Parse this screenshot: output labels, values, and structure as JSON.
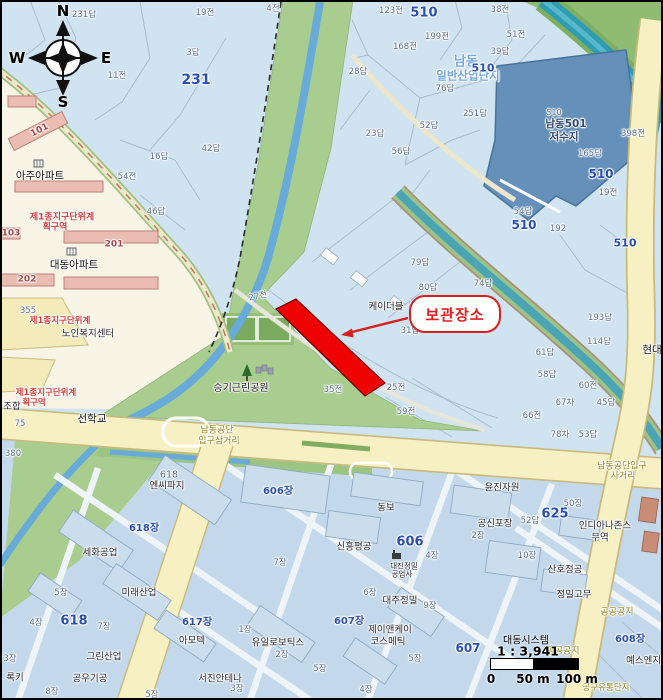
{
  "map": {
    "storage_label": "보관장소",
    "compass": {
      "n": "N",
      "w": "W",
      "e": "E",
      "s": "S"
    },
    "scale": {
      "company": "대동시스템",
      "ratio": "1 : 3,941",
      "tick_0": "0",
      "tick_50": "50 m",
      "tick_100": "100 m"
    },
    "colors": {
      "highlight_red": "#ee0202",
      "label_red": "#d62020",
      "base_blue": "#cfe3f1",
      "industrial_blue": "#c3d9eb",
      "road_yellow": "#f7f0c2",
      "park_green": "#a9cd8e",
      "stream_blue": "#68aad8",
      "river_teal": "#2f9cb4",
      "reservoir_blue": "#6490ba",
      "cream": "#f8f4e6"
    },
    "labels": [
      {
        "text": "231답",
        "x": 84,
        "y": 15,
        "c": "g"
      },
      {
        "text": "19전",
        "x": 205,
        "y": 13,
        "c": "g"
      },
      {
        "text": "4전",
        "x": 273,
        "y": 9,
        "c": "g"
      },
      {
        "text": "123전",
        "x": 391,
        "y": 11,
        "c": "g"
      },
      {
        "text": "510",
        "x": 424,
        "y": 13,
        "c": "bb"
      },
      {
        "text": "38전",
        "x": 500,
        "y": 10,
        "c": "g"
      },
      {
        "text": "3답",
        "x": 193,
        "y": 53,
        "c": "g"
      },
      {
        "text": "231",
        "x": 196,
        "y": 80,
        "c": "bb",
        "s": 14
      },
      {
        "text": "11전",
        "x": 117,
        "y": 76,
        "c": "g"
      },
      {
        "text": "199전",
        "x": 437,
        "y": 37,
        "c": "g"
      },
      {
        "text": "51전",
        "x": 516,
        "y": 35,
        "c": "g"
      },
      {
        "text": "168전",
        "x": 405,
        "y": 47,
        "c": "g"
      },
      {
        "text": "39답",
        "x": 500,
        "y": 52,
        "c": "g"
      },
      {
        "text": "28답",
        "x": 358,
        "y": 72,
        "c": "g"
      },
      {
        "text": "남동",
        "x": 466,
        "y": 62,
        "c": "lb"
      },
      {
        "text": "일반산업단지",
        "x": 468,
        "y": 76,
        "c": "lb",
        "s": 11.5
      },
      {
        "text": "510",
        "x": 483,
        "y": 68,
        "c": "bb",
        "s": 11
      },
      {
        "text": "76답",
        "x": 445,
        "y": 89,
        "c": "g"
      },
      {
        "text": "251답",
        "x": 475,
        "y": 114,
        "c": "g"
      },
      {
        "text": "52답",
        "x": 429,
        "y": 126,
        "c": "g"
      },
      {
        "text": "23답",
        "x": 375,
        "y": 134,
        "c": "g"
      },
      {
        "text": "56답",
        "x": 401,
        "y": 152,
        "c": "g"
      },
      {
        "text": "42답",
        "x": 211,
        "y": 149,
        "c": "g"
      },
      {
        "text": "16답",
        "x": 159,
        "y": 157,
        "c": "g"
      },
      {
        "text": "54전",
        "x": 127,
        "y": 177,
        "c": "g"
      },
      {
        "text": "46답",
        "x": 156,
        "y": 212,
        "c": "g"
      },
      {
        "text": "510",
        "x": 554,
        "y": 113,
        "c": "g",
        "s": 8
      },
      {
        "text": "남동501",
        "x": 566,
        "y": 124,
        "c": "nv"
      },
      {
        "text": "저수지",
        "x": 564,
        "y": 137,
        "c": "nv"
      },
      {
        "text": "398전",
        "x": 633,
        "y": 134,
        "c": "g"
      },
      {
        "text": "165답",
        "x": 590,
        "y": 154,
        "c": "g"
      },
      {
        "text": "510",
        "x": 601,
        "y": 174,
        "c": "bb",
        "s": 12
      },
      {
        "text": "19전",
        "x": 608,
        "y": 193,
        "c": "g"
      },
      {
        "text": "54답",
        "x": 523,
        "y": 212,
        "c": "g"
      },
      {
        "text": "510",
        "x": 524,
        "y": 225,
        "c": "bb",
        "s": 12
      },
      {
        "text": "192",
        "x": 558,
        "y": 229,
        "c": "g"
      },
      {
        "text": "510",
        "x": 625,
        "y": 243,
        "c": "bb",
        "s": 11
      },
      {
        "text": "101",
        "x": 40,
        "y": 131,
        "c": "dr",
        "rot": -27
      },
      {
        "text": "아주아파트",
        "x": 40,
        "y": 176,
        "c": "kb"
      },
      {
        "text": "제1종지구단위계",
        "x": 62,
        "y": 218,
        "c": "r"
      },
      {
        "text": "획구역",
        "x": 55,
        "y": 228,
        "c": "r"
      },
      {
        "text": "103",
        "x": 11,
        "y": 234,
        "c": "dr"
      },
      {
        "text": "201",
        "x": 114,
        "y": 245,
        "c": "dr"
      },
      {
        "text": "대동아파트",
        "x": 74,
        "y": 265,
        "c": "kb"
      },
      {
        "text": "202",
        "x": 27,
        "y": 280,
        "c": "dr"
      },
      {
        "text": "355",
        "x": 28,
        "y": 311,
        "c": "g"
      },
      {
        "text": "제1종지구단위계",
        "x": 60,
        "y": 321,
        "c": "r",
        "s": 8.5
      },
      {
        "text": "노인복지센터",
        "x": 88,
        "y": 334,
        "c": "k"
      },
      {
        "text": "제1종지구단위계",
        "x": 46,
        "y": 393,
        "c": "r",
        "s": 8.5
      },
      {
        "text": "획구역",
        "x": 34,
        "y": 403,
        "c": "r",
        "s": 8.5
      },
      {
        "text": "조합",
        "x": 12,
        "y": 407,
        "c": "k"
      },
      {
        "text": "75",
        "x": 20,
        "y": 424,
        "c": "g"
      },
      {
        "text": "380",
        "x": 13,
        "y": 454,
        "c": "g"
      },
      {
        "text": "선학교",
        "x": 92,
        "y": 419,
        "c": "kb"
      },
      {
        "text": "남동공단",
        "x": 217,
        "y": 431,
        "c": "o"
      },
      {
        "text": "입구삼거리",
        "x": 219,
        "y": 442,
        "c": "o"
      },
      {
        "text": "승기근린공원",
        "x": 241,
        "y": 389,
        "c": "kb",
        "s": 10
      },
      {
        "text": "27전",
        "x": 258,
        "y": 297,
        "c": "g",
        "rot": -12
      },
      {
        "text": "케이더블",
        "x": 386,
        "y": 307,
        "c": "k"
      },
      {
        "text": "79답",
        "x": 420,
        "y": 263,
        "c": "g"
      },
      {
        "text": "80답",
        "x": 428,
        "y": 288,
        "c": "g"
      },
      {
        "text": "74답",
        "x": 483,
        "y": 284,
        "c": "g"
      },
      {
        "text": "31답",
        "x": 410,
        "y": 331,
        "c": "g"
      },
      {
        "text": "193답",
        "x": 600,
        "y": 318,
        "c": "g"
      },
      {
        "text": "114답",
        "x": 599,
        "y": 342,
        "c": "g"
      },
      {
        "text": "61답",
        "x": 545,
        "y": 353,
        "c": "g"
      },
      {
        "text": "58답",
        "x": 547,
        "y": 375,
        "c": "g"
      },
      {
        "text": "60전",
        "x": 588,
        "y": 386,
        "c": "g"
      },
      {
        "text": "67차",
        "x": 565,
        "y": 403,
        "c": "g"
      },
      {
        "text": "45답",
        "x": 606,
        "y": 403,
        "c": "g"
      },
      {
        "text": "35전",
        "x": 333,
        "y": 390,
        "c": "g"
      },
      {
        "text": "25전",
        "x": 396,
        "y": 388,
        "c": "g"
      },
      {
        "text": "59전",
        "x": 406,
        "y": 412,
        "c": "g"
      },
      {
        "text": "66전",
        "x": 532,
        "y": 416,
        "c": "g"
      },
      {
        "text": "78차",
        "x": 560,
        "y": 435,
        "c": "g"
      },
      {
        "text": "53답",
        "x": 588,
        "y": 435,
        "c": "g"
      },
      {
        "text": "현대",
        "x": 652,
        "y": 350,
        "c": "kb"
      },
      {
        "text": "남동공단입구",
        "x": 622,
        "y": 467,
        "c": "o"
      },
      {
        "text": "사거리",
        "x": 623,
        "y": 477,
        "c": "o"
      },
      {
        "text": "윤진자원",
        "x": 502,
        "y": 488,
        "c": "k"
      },
      {
        "text": "50장",
        "x": 573,
        "y": 504,
        "c": "g"
      },
      {
        "text": "625",
        "x": 555,
        "y": 514,
        "c": "bb"
      },
      {
        "text": "52답",
        "x": 530,
        "y": 521,
        "c": "g"
      },
      {
        "text": "공신포장",
        "x": 495,
        "y": 524,
        "c": "k"
      },
      {
        "text": "2장",
        "x": 478,
        "y": 536,
        "c": "g"
      },
      {
        "text": "인디아나존스",
        "x": 605,
        "y": 526,
        "c": "k"
      },
      {
        "text": "무역",
        "x": 600,
        "y": 538,
        "c": "k"
      },
      {
        "text": "10장",
        "x": 527,
        "y": 556,
        "c": "g"
      },
      {
        "text": "산호정공",
        "x": 565,
        "y": 570,
        "c": "k"
      },
      {
        "text": "정밀고무",
        "x": 574,
        "y": 595,
        "c": "k"
      },
      {
        "text": "공공공지",
        "x": 617,
        "y": 613,
        "c": "o"
      },
      {
        "text": "608장",
        "x": 630,
        "y": 640,
        "c": "bs"
      },
      {
        "text": "공공공지",
        "x": 563,
        "y": 652,
        "c": "o"
      },
      {
        "text": "607",
        "x": 468,
        "y": 648,
        "c": "bb",
        "s": 12
      },
      {
        "text": "예스엔지니",
        "x": 648,
        "y": 661,
        "c": "k"
      },
      {
        "text": "공구유통단지",
        "x": 606,
        "y": 688,
        "c": "o",
        "s": 8.5
      },
      {
        "text": "618",
        "x": 169,
        "y": 475,
        "c": "g",
        "s": 9.5
      },
      {
        "text": "엔씨파지",
        "x": 167,
        "y": 486,
        "c": "k"
      },
      {
        "text": "618장",
        "x": 144,
        "y": 529,
        "c": "bs"
      },
      {
        "text": "세화공업",
        "x": 100,
        "y": 553,
        "c": "k"
      },
      {
        "text": "5장",
        "x": 61,
        "y": 593,
        "c": "g"
      },
      {
        "text": "미래산업",
        "x": 139,
        "y": 593,
        "c": "k"
      },
      {
        "text": "618",
        "x": 74,
        "y": 621,
        "c": "bb"
      },
      {
        "text": "4장",
        "x": 36,
        "y": 623,
        "c": "g"
      },
      {
        "text": "7장",
        "x": 104,
        "y": 627,
        "c": "g"
      },
      {
        "text": "617장",
        "x": 197,
        "y": 623,
        "c": "bs"
      },
      {
        "text": "아모텍",
        "x": 192,
        "y": 641,
        "c": "k"
      },
      {
        "text": "3장",
        "x": 10,
        "y": 659,
        "c": "g"
      },
      {
        "text": "그린산업",
        "x": 104,
        "y": 657,
        "c": "k"
      },
      {
        "text": "록키",
        "x": 15,
        "y": 678,
        "c": "k"
      },
      {
        "text": "공우기공",
        "x": 90,
        "y": 679,
        "c": "k"
      },
      {
        "text": "8장",
        "x": 52,
        "y": 692,
        "c": "g"
      },
      {
        "text": "5장",
        "x": 152,
        "y": 695,
        "c": "g"
      },
      {
        "text": "유일로보틱스",
        "x": 278,
        "y": 643,
        "c": "k"
      },
      {
        "text": "2장",
        "x": 282,
        "y": 655,
        "c": "g"
      },
      {
        "text": "서진안테나",
        "x": 220,
        "y": 679,
        "c": "k"
      },
      {
        "text": "3장",
        "x": 237,
        "y": 689,
        "c": "g"
      },
      {
        "text": "606장",
        "x": 278,
        "y": 492,
        "c": "bs"
      },
      {
        "text": "동보",
        "x": 386,
        "y": 508,
        "c": "k"
      },
      {
        "text": "신흥평공",
        "x": 354,
        "y": 547,
        "c": "k"
      },
      {
        "text": "606",
        "x": 410,
        "y": 542,
        "c": "bb"
      },
      {
        "text": "4장",
        "x": 432,
        "y": 556,
        "c": "g"
      },
      {
        "text": "대진정밀",
        "x": 404,
        "y": 566,
        "c": "k",
        "s": 7.5
      },
      {
        "text": "공업사",
        "x": 402,
        "y": 574,
        "c": "k",
        "s": 7.5
      },
      {
        "text": "7장",
        "x": 280,
        "y": 563,
        "c": "g"
      },
      {
        "text": "6장",
        "x": 370,
        "y": 593,
        "c": "g"
      },
      {
        "text": "대주정밀",
        "x": 400,
        "y": 601,
        "c": "k"
      },
      {
        "text": "9장",
        "x": 430,
        "y": 606,
        "c": "g"
      },
      {
        "text": "607장",
        "x": 349,
        "y": 622,
        "c": "bs"
      },
      {
        "text": "제이앤케이",
        "x": 390,
        "y": 630,
        "c": "k"
      },
      {
        "text": "코스메틱",
        "x": 388,
        "y": 642,
        "c": "k"
      },
      {
        "text": "5장",
        "x": 415,
        "y": 659,
        "c": "g"
      },
      {
        "text": "5장",
        "x": 320,
        "y": 669,
        "c": "g"
      },
      {
        "text": "4장",
        "x": 366,
        "y": 690,
        "c": "g"
      },
      {
        "text": "1장",
        "x": 245,
        "y": 630,
        "c": "g"
      }
    ]
  }
}
